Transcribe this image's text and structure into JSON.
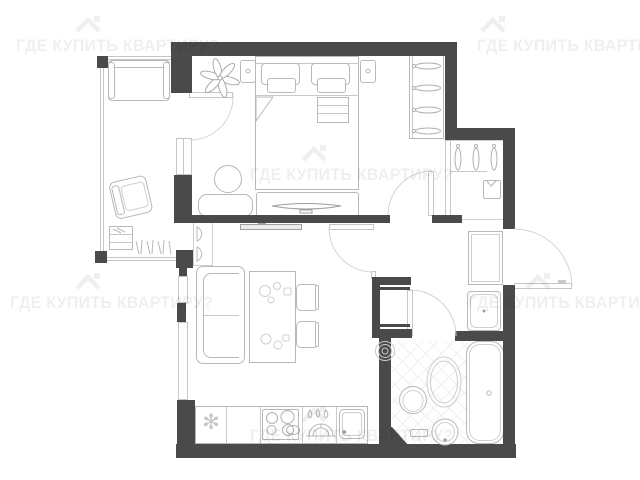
{
  "canvas": {
    "width": 640,
    "height": 480,
    "background": "#ffffff"
  },
  "watermark": {
    "text": "ГДЕ КУПИТЬ КВАРТИРУ?",
    "logo": "house-icon",
    "color": "rgba(0,0,0,0.062)"
  },
  "plan": {
    "type": "apartment-floor-plan",
    "wall_color": "#4a4a4a",
    "furniture_line_color": "#b8b8b8",
    "fridge_symbol": "✻",
    "rooms": [
      {
        "name": "balcony",
        "items": [
          "balcony-sofa",
          "armchair",
          "bookshelf",
          "book-row"
        ]
      },
      {
        "name": "bedroom",
        "items": [
          "double-bed",
          "pillows",
          "folded-blanket",
          "nightstand-left",
          "nightstand-right",
          "plant",
          "wardrobe-hangers",
          "round-pouf",
          "bench",
          "tv-console",
          "tv"
        ]
      },
      {
        "name": "living-kitchen",
        "items": [
          "sofa",
          "dining-table",
          "dining-chairs",
          "table-decor",
          "wall-tv",
          "decor-shelf",
          "fridge",
          "hob",
          "drying-rack",
          "kitchen-sink",
          "counter",
          "windows"
        ]
      },
      {
        "name": "hallway",
        "items": [
          "closet-hangers",
          "folded-shirt",
          "hall-cabinet",
          "washing-machine",
          "utility-shaft"
        ]
      },
      {
        "name": "bathroom",
        "items": [
          "bathtub",
          "toilet",
          "oval-rug",
          "round-sink",
          "bath-shelf",
          "towel-rings",
          "tiled-floor"
        ]
      }
    ],
    "doors": [
      "balcony-door",
      "bedroom-door",
      "living-room-door",
      "bathroom-door",
      "entrance-door"
    ]
  }
}
